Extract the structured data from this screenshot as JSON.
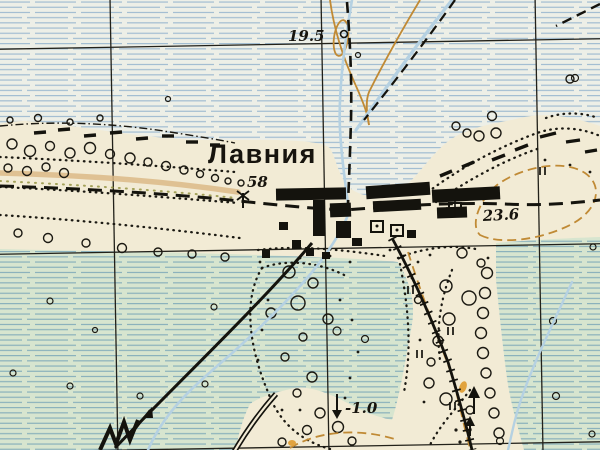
{
  "map": {
    "settlement": {
      "name_label": "Лавния"
    },
    "spot_heights": [
      {
        "value": "19.5"
      },
      {
        "value": "58"
      },
      {
        "value": "23.6"
      }
    ],
    "water_level_mark": {
      "value": "-1.0"
    }
  },
  "colors": {
    "paper": "#f2ebd5",
    "meadow_bg": "#edefe7",
    "hatch_blue": "#9cb9d0",
    "marsh_green": "#d7e5cf",
    "marsh_hatch_blue": "#84adba",
    "ink": "#1b1912",
    "contour_orange": "#c08a35",
    "stream_blue": "#b5d1e2",
    "track_tan": "#dcba87"
  }
}
